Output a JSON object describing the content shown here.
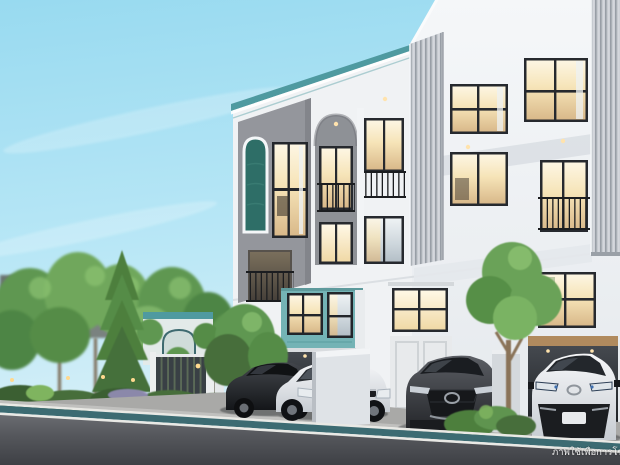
{
  "meta": {
    "width": 620,
    "height": 465,
    "kind": "architectural-exterior-render",
    "time_of_day": "daytime"
  },
  "watermark": {
    "text": "ภาพใช้เพื่อการโฆษณา",
    "visible_text": "ภาพใช้เพื่อการโ"
  },
  "palette": {
    "sky_top": "#98daf0",
    "sky_horizon": "#ddf1f8",
    "teal_coping": "#4f9aa0",
    "teal_ground_facade": "#74b3b5",
    "teal_arch_niche": "#2e6e67",
    "wall_white": "#f1f3f5",
    "wall_gray_panel": "#94969c",
    "warm_window_light": "#f6e4b8",
    "lane_stripe_teal": "#3c6b72",
    "asphalt": "#4a4c51",
    "foliage_green": "#5f9751"
  },
  "scene": {
    "building": "three-storey modern townhome row, white with gray recessed panels, arched features and teal accents",
    "left_unit_feature": "teal arched textured niche",
    "ground_floor_feature": "teal facade with carport",
    "cars": [
      "dark-gray sedan",
      "white sedan",
      "gray mazda cx-5 suv",
      "white toyota c-hr suv"
    ],
    "landscape": [
      "garden trees",
      "tall conifer",
      "slatted entry gate",
      "arched garden pavilion",
      "hedge row",
      "garden lamps"
    ],
    "road_feature": "teal cycle-lane stripe with white edge lines along the curb"
  }
}
